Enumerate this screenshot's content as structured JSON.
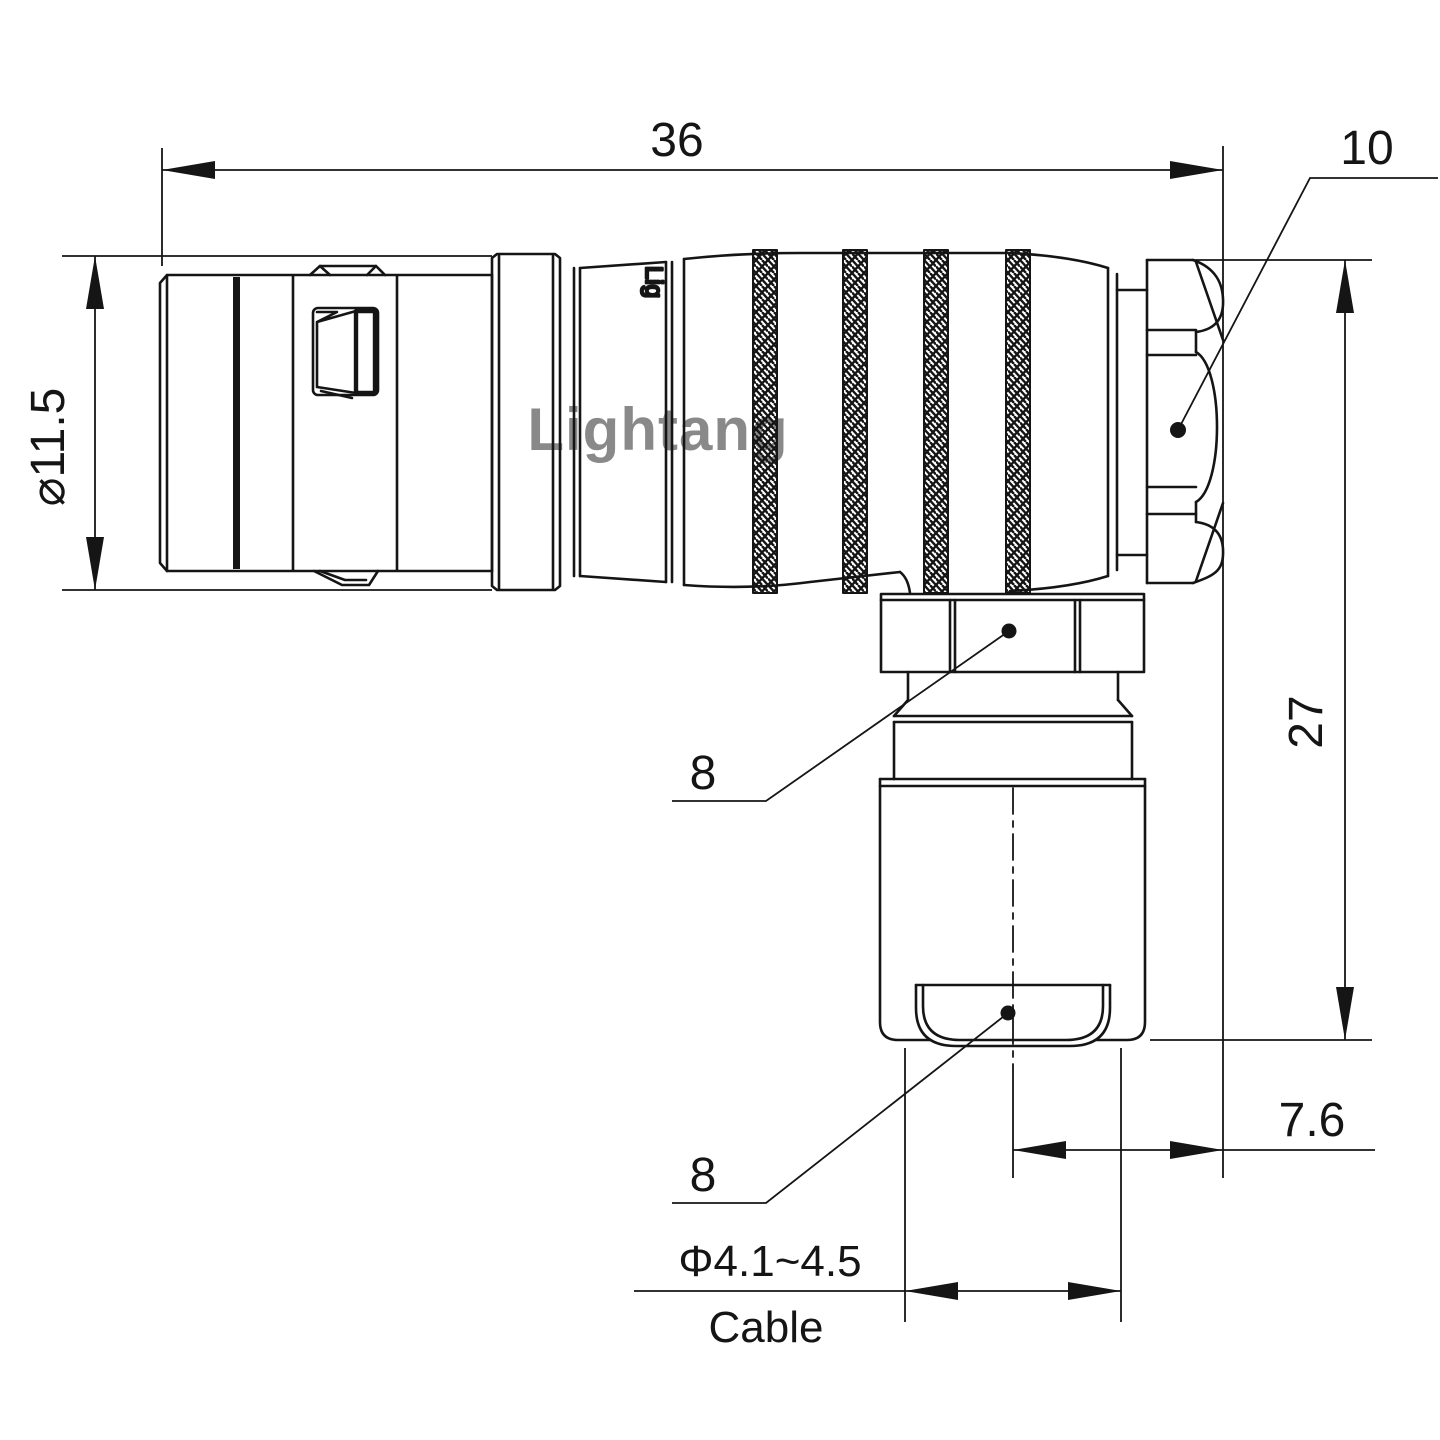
{
  "drawing": {
    "type": "technical-drawing",
    "line_color": "#151515",
    "background": "#ffffff",
    "watermark": {
      "text": "Lightang",
      "color": "#efabab"
    },
    "shell_marking": "Lig",
    "labels": {
      "overall_length": "36",
      "end_nut_size": "10",
      "shell_diameter": "⌀11.5",
      "overall_height": "27",
      "backnut_size": "8",
      "bushing_size": "8",
      "axis_offset": "7.6",
      "cable_range": "Φ4.1~4.5",
      "cable_word": "Cable"
    }
  }
}
